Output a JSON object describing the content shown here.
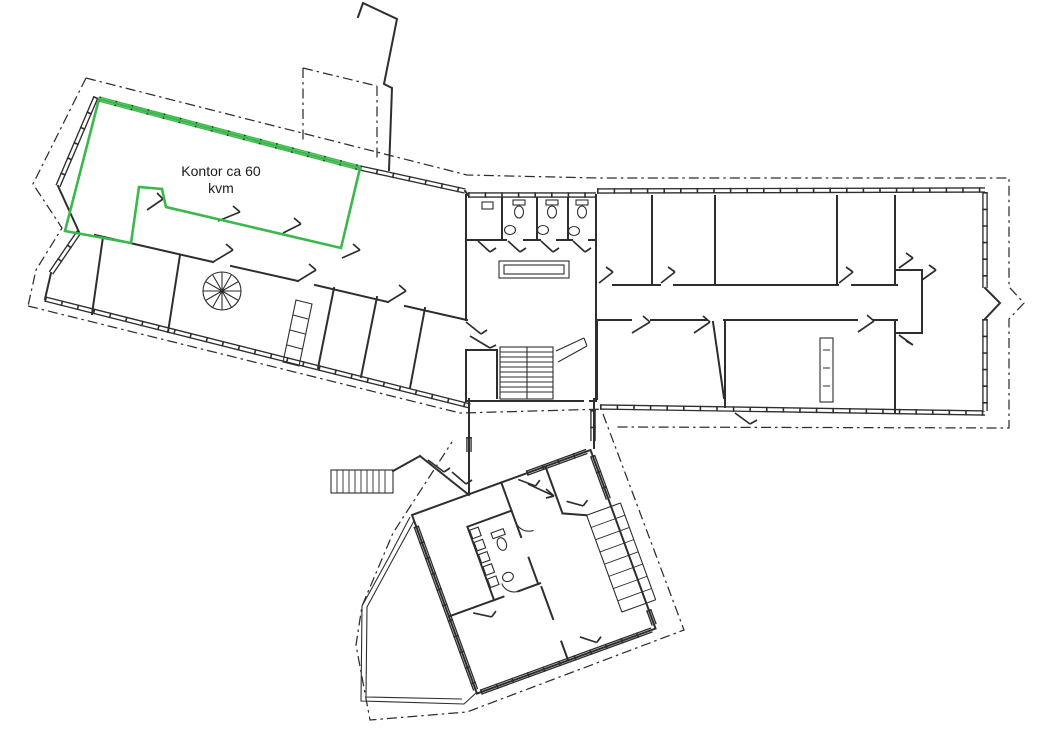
{
  "labels": {
    "office_area_line1": "Kontor ca 60",
    "office_area_line2": "kvm"
  },
  "colors": {
    "ink": "#2e2e2e",
    "highlight_green": "#3bb84b",
    "paper": "#ffffff"
  }
}
